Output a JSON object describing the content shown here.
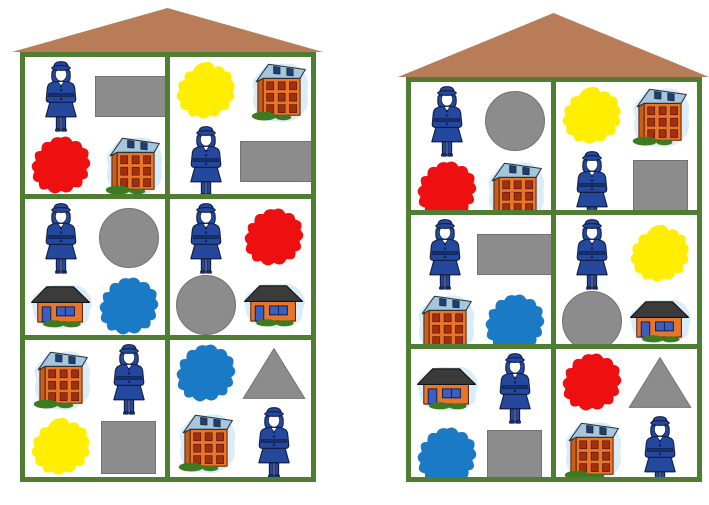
{
  "title": "police-shape-house-matching-cards",
  "background": "#ffffff",
  "colors": {
    "frame_green": "#4f7d31",
    "roof_brown": "#b97c58",
    "red": "#ee1010",
    "yellow": "#ffee00",
    "blue": "#1b7ac5",
    "gray": "#8c8c8c",
    "halo_blue": "#d9ecf8",
    "building_orange": "#e8762a",
    "building_roof_blue": "#a6c6dc",
    "officer_blue": "#24489e",
    "grass_green": "#3d7a20"
  },
  "item_labels": {
    "officer": "police-officer-icon",
    "building": "tall-building-icon",
    "house": "small-house-icon",
    "red": "red-blob-icon",
    "yellow": "yellow-blob-icon",
    "blue": "blue-blob-icon",
    "rect": "gray-rectangle-icon",
    "square": "gray-square-icon",
    "circle": "gray-circle-icon",
    "triangle": "gray-triangle-icon"
  },
  "houses": [
    {
      "name": "left-house",
      "grid": {
        "rows": 3,
        "cols": 2
      },
      "cells": [
        {
          "row": 1,
          "col": 1,
          "items": [
            "officer",
            "rect",
            "red",
            "building"
          ]
        },
        {
          "row": 1,
          "col": 2,
          "items": [
            "yellow",
            "building",
            "officer",
            "rect"
          ]
        },
        {
          "row": 2,
          "col": 1,
          "items": [
            "officer",
            "circle",
            "house",
            "blue"
          ]
        },
        {
          "row": 2,
          "col": 2,
          "items": [
            "officer",
            "red",
            "circle",
            "house"
          ]
        },
        {
          "row": 3,
          "col": 1,
          "items": [
            "building",
            "officer",
            "yellow",
            "square"
          ]
        },
        {
          "row": 3,
          "col": 2,
          "items": [
            "blue",
            "triangle",
            "building",
            "officer"
          ]
        }
      ]
    },
    {
      "name": "right-house",
      "grid": {
        "rows": 3,
        "cols": 2
      },
      "cells": [
        {
          "row": 1,
          "col": 1,
          "items": [
            "officer",
            "circle",
            "red",
            "building"
          ]
        },
        {
          "row": 1,
          "col": 2,
          "items": [
            "yellow",
            "building",
            "officer",
            "square"
          ]
        },
        {
          "row": 2,
          "col": 1,
          "items": [
            "officer",
            "rect",
            "building",
            "blue"
          ]
        },
        {
          "row": 2,
          "col": 2,
          "items": [
            "officer",
            "yellow",
            "circle",
            "house"
          ]
        },
        {
          "row": 3,
          "col": 1,
          "items": [
            "house",
            "officer",
            "blue",
            "square"
          ]
        },
        {
          "row": 3,
          "col": 2,
          "items": [
            "red",
            "triangle",
            "building",
            "officer"
          ]
        }
      ]
    }
  ]
}
